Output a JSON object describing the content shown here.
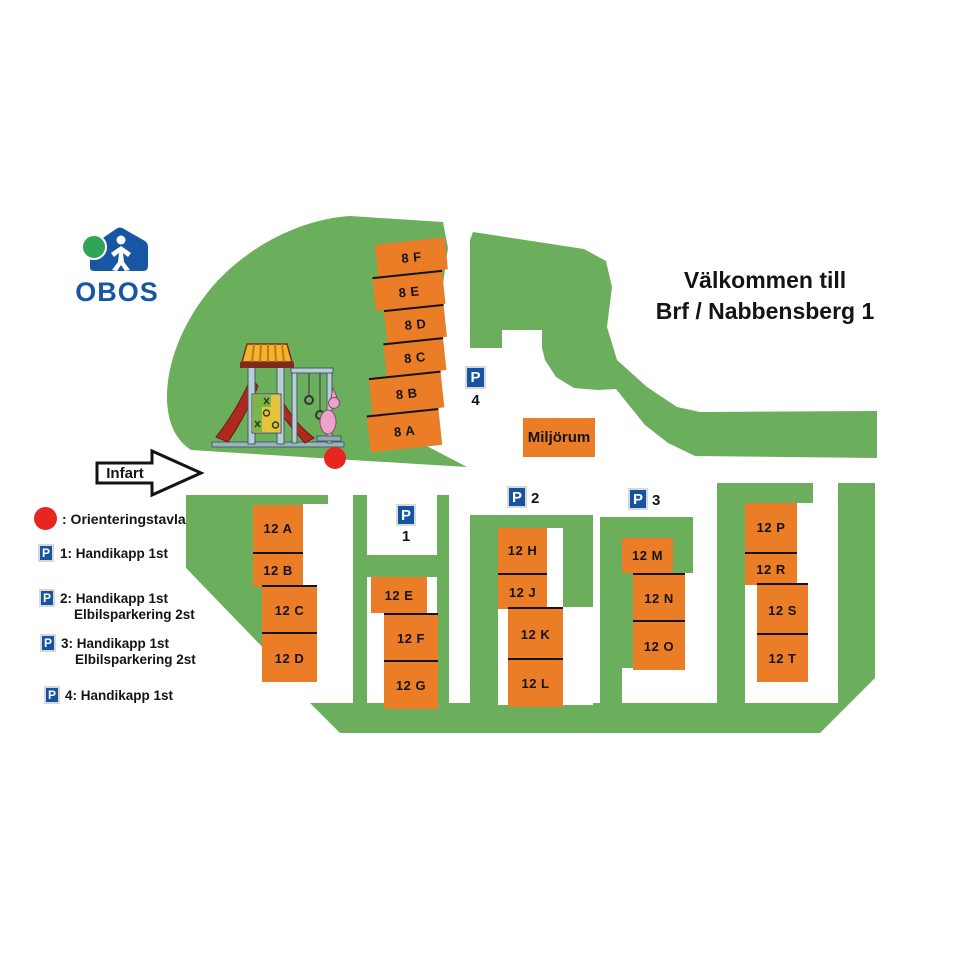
{
  "logo": {
    "brand": "OBOS"
  },
  "title": {
    "line1": "Välkommen till",
    "line2": "Brf / Nabbensberg 1"
  },
  "entrance_label": "Infart",
  "map": {
    "miljorum_label": "Miljörum",
    "buildings_8": [
      "8 F",
      "8 E",
      "8 D",
      "8 C",
      "8 B",
      "8 A"
    ],
    "clusters": [
      {
        "units": [
          "12 A",
          "12 B",
          "12 C",
          "12 D"
        ]
      },
      {
        "units": [
          "12 E",
          "12 F",
          "12 G"
        ]
      },
      {
        "units": [
          "12 H",
          "12 J",
          "12 K",
          "12 L"
        ]
      },
      {
        "units": [
          "12 M",
          "12 N",
          "12 O"
        ]
      },
      {
        "units": [
          "12 P",
          "12 R",
          "12 S",
          "12 T"
        ]
      }
    ],
    "parking_signs": [
      {
        "letter": "P",
        "number": "1"
      },
      {
        "letter": "P",
        "number": "2"
      },
      {
        "letter": "P",
        "number": "3"
      },
      {
        "letter": "P",
        "number": "4"
      }
    ]
  },
  "legend": {
    "marker_label": ": Orienteringstavla",
    "items": [
      {
        "letter": "P",
        "line1": "1: Handikapp 1st",
        "line2": ""
      },
      {
        "letter": "P",
        "line1": "2: Handikapp 1st",
        "line2": "Elbilsparkering 2st"
      },
      {
        "letter": "P",
        "line1": "3: Handikapp 1st",
        "line2": "Elbilsparkering 2st"
      },
      {
        "letter": "P",
        "line1": "4: Handikapp 1st",
        "line2": ""
      }
    ]
  },
  "colors": {
    "grass_green": "#6BAF5C",
    "building_orange": "#EB7D26",
    "sign_blue": "#15549E",
    "brand_blue": "#1856A3",
    "brand_green": "#2FA356",
    "marker_red": "#E8251F"
  }
}
